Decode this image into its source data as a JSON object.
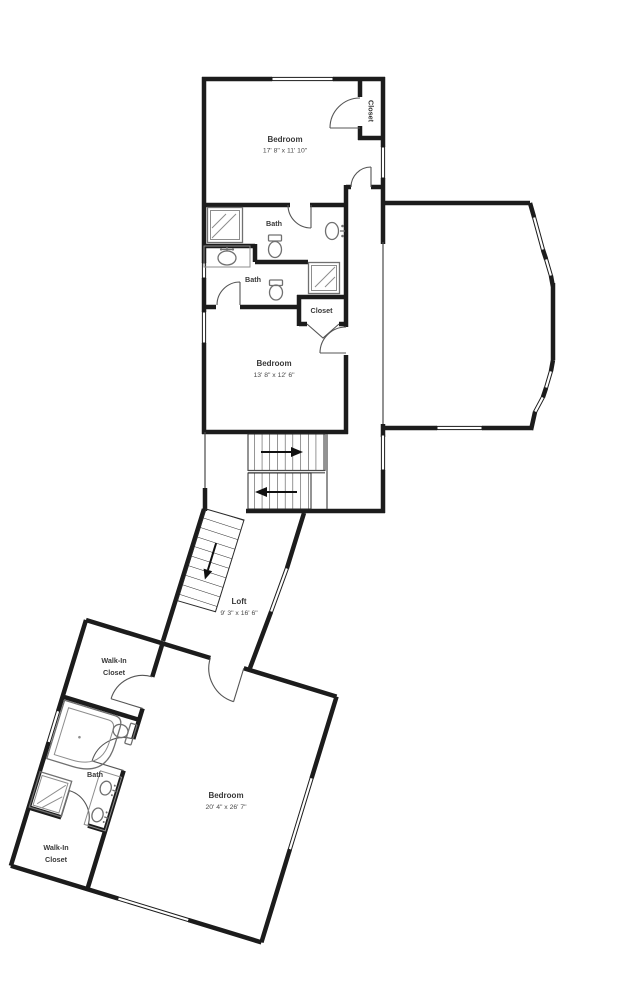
{
  "floorplan": {
    "rooms": {
      "bedroom1": {
        "name": "Bedroom",
        "dims": "17' 8\" x 11' 10\""
      },
      "closet1": {
        "name": "Closet"
      },
      "bath1": {
        "name": "Bath"
      },
      "bath2": {
        "name": "Bath"
      },
      "closet2": {
        "name": "Closet"
      },
      "bedroom2": {
        "name": "Bedroom",
        "dims": "13' 8\" x 12' 6\""
      },
      "loft": {
        "name": "Loft",
        "dims": "9' 3\" x 16' 6\""
      },
      "walk_in_closet1": {
        "line1": "Walk-In",
        "line2": "Closet"
      },
      "bath3": {
        "name": "Bath"
      },
      "walk_in_closet2": {
        "line1": "Walk-In",
        "line2": "Closet"
      },
      "bedroom3": {
        "name": "Bedroom",
        "dims": "20' 4\" x 26' 7\""
      }
    },
    "colors": {
      "wall": "#1c1c1c",
      "fixture": "#707070",
      "text": "#3a3a3a",
      "background": "#ffffff"
    }
  }
}
